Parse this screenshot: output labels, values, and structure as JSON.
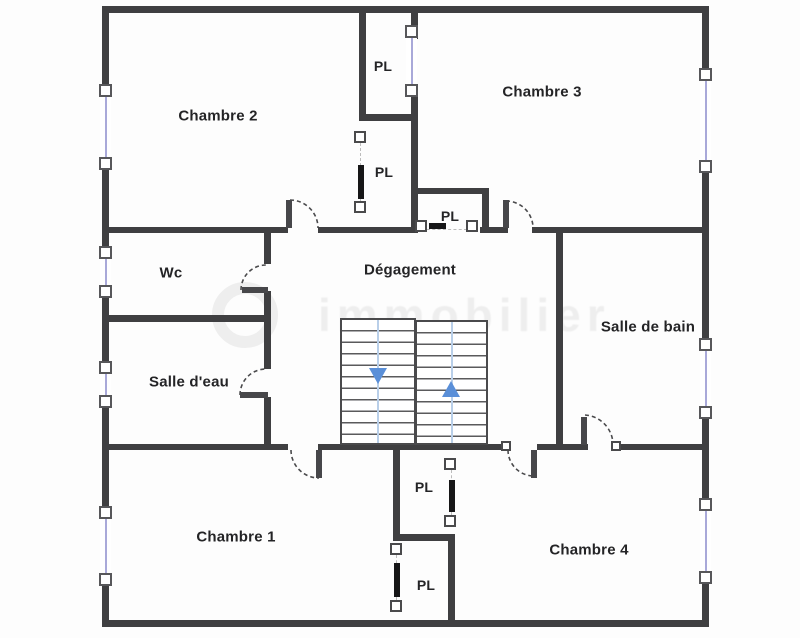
{
  "plan": {
    "rooms": [
      {
        "name": "chambre-2",
        "label": "Chambre 2"
      },
      {
        "name": "chambre-3",
        "label": "Chambre 3"
      },
      {
        "name": "wc",
        "label": "Wc"
      },
      {
        "name": "degagement",
        "label": "Dégagement"
      },
      {
        "name": "salle-de-bain",
        "label": "Salle de bain"
      },
      {
        "name": "salle-d-eau",
        "label": "Salle d'eau"
      },
      {
        "name": "chambre-1",
        "label": "Chambre 1"
      },
      {
        "name": "chambre-4",
        "label": "Chambre 4"
      }
    ],
    "closets": [
      {
        "label": "PL"
      },
      {
        "label": "PL"
      },
      {
        "label": "PL"
      },
      {
        "label": "PL"
      },
      {
        "label": "PL"
      }
    ],
    "watermark": "immobilier",
    "colors": {
      "wall": "#3f3f41",
      "window_glass": "#a9a9d9",
      "stair_rail": "#b9cfe9",
      "arrow_blue": "#5a8fd8",
      "watermark_gray": "#d9d9d9"
    }
  }
}
